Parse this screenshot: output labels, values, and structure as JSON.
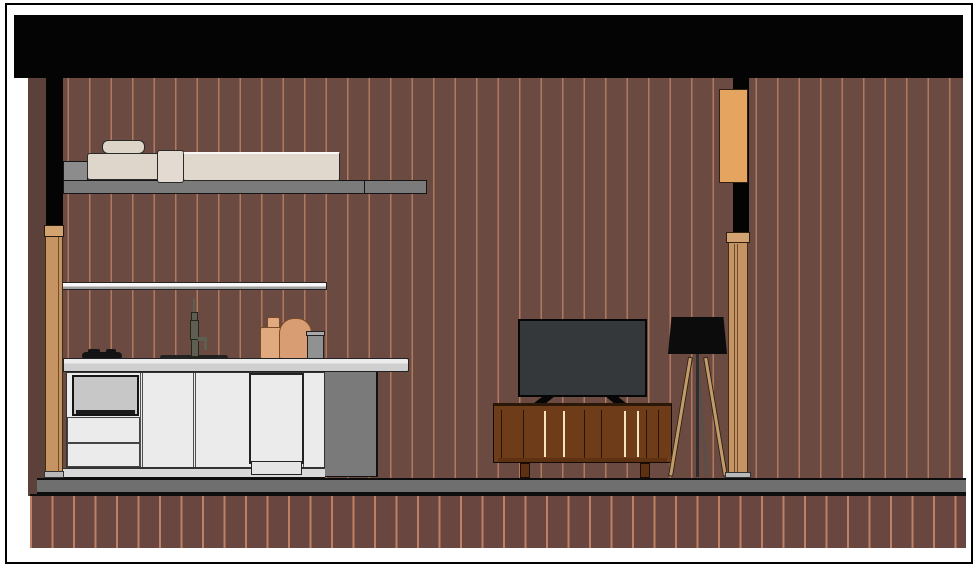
{
  "scene": {
    "kind": "architectural-section-elevation",
    "description": "Section elevation of a studio apartment: loft bed platform above a kitchen run on the left, TV on a wooden media console with a tripod floor lamp on the right, striped wall finish, black ceiling void band, gray floor slab over a striped plinth band",
    "objects": [
      "sheet-frame",
      "ceiling-void",
      "striped-wall",
      "left-cut-wall",
      "left-window-post",
      "loft-platform",
      "bed-mattress",
      "pillow",
      "duvet-roll",
      "wall-shelf",
      "kitchen-counter",
      "kitchen-cabinets",
      "wall-oven",
      "cabinet-drawers",
      "dishwasher",
      "counter-side-panel",
      "cooktop",
      "sink",
      "faucet",
      "cutting-board",
      "cutting-board-2",
      "canister",
      "tv",
      "media-console",
      "tripod-floor-lamp",
      "orange-wall-panel",
      "right-window-post",
      "floor-slab",
      "plinth-band"
    ]
  },
  "colors": {
    "frame_border": "#000000",
    "paper": "#ffffff",
    "ceiling_black": "#040404",
    "wall_base": "#6b4a42",
    "wall_stripe": "#b1795d",
    "plinth_base": "#694740",
    "plinth_stripe": "#bd8064",
    "left_wall_cut": "#5b4139",
    "floor_gray": "#6f6f6f",
    "mezzanine_gray": "#7b7b7b",
    "mezzanine_step_gray": "#8c8c8c",
    "outline_dark": "#1c1c1c",
    "bed_cream": "#ded6cb",
    "bed_highlight": "#faf8f4",
    "post_tan": "#c69463",
    "post_cap_tan": "#d2a271",
    "post_outline": "#3d2c18",
    "shelf_white": "#f8f8f8",
    "shelf_under": "#a0a0a0",
    "counter_top": "#ececec",
    "counter_front": "#cfcfcf",
    "cabinet_white": "#ebebeb",
    "cabinet_line": "#4f4f4f",
    "toe_gray": "#d9d9d9",
    "side_panel_gray": "#7a7a7a",
    "oven_screen": "#c7c7c7",
    "appliance_black": "#141414",
    "faucet_olive": "#5d5f52",
    "board_tan_light": "#e0a97e",
    "board_tan": "#d89d72",
    "board_outline": "#7a4a28",
    "canister_gray": "#909292",
    "canister_lid": "#a8a8a8",
    "tv_screen": "#35383b",
    "tv_black": "#060606",
    "console_wood": "#6f3c1a",
    "console_wood_dark": "#5e3113",
    "console_seam": "#2a1507",
    "console_slat_light": "#f2e4bc",
    "lamp_black": "#0c0c0c",
    "lamp_leg_tan": "#c39a6a",
    "lamp_pole": "#2e2e2e",
    "window_orange": "#e6a461",
    "base_plate_gray": "#b9b9b9"
  }
}
